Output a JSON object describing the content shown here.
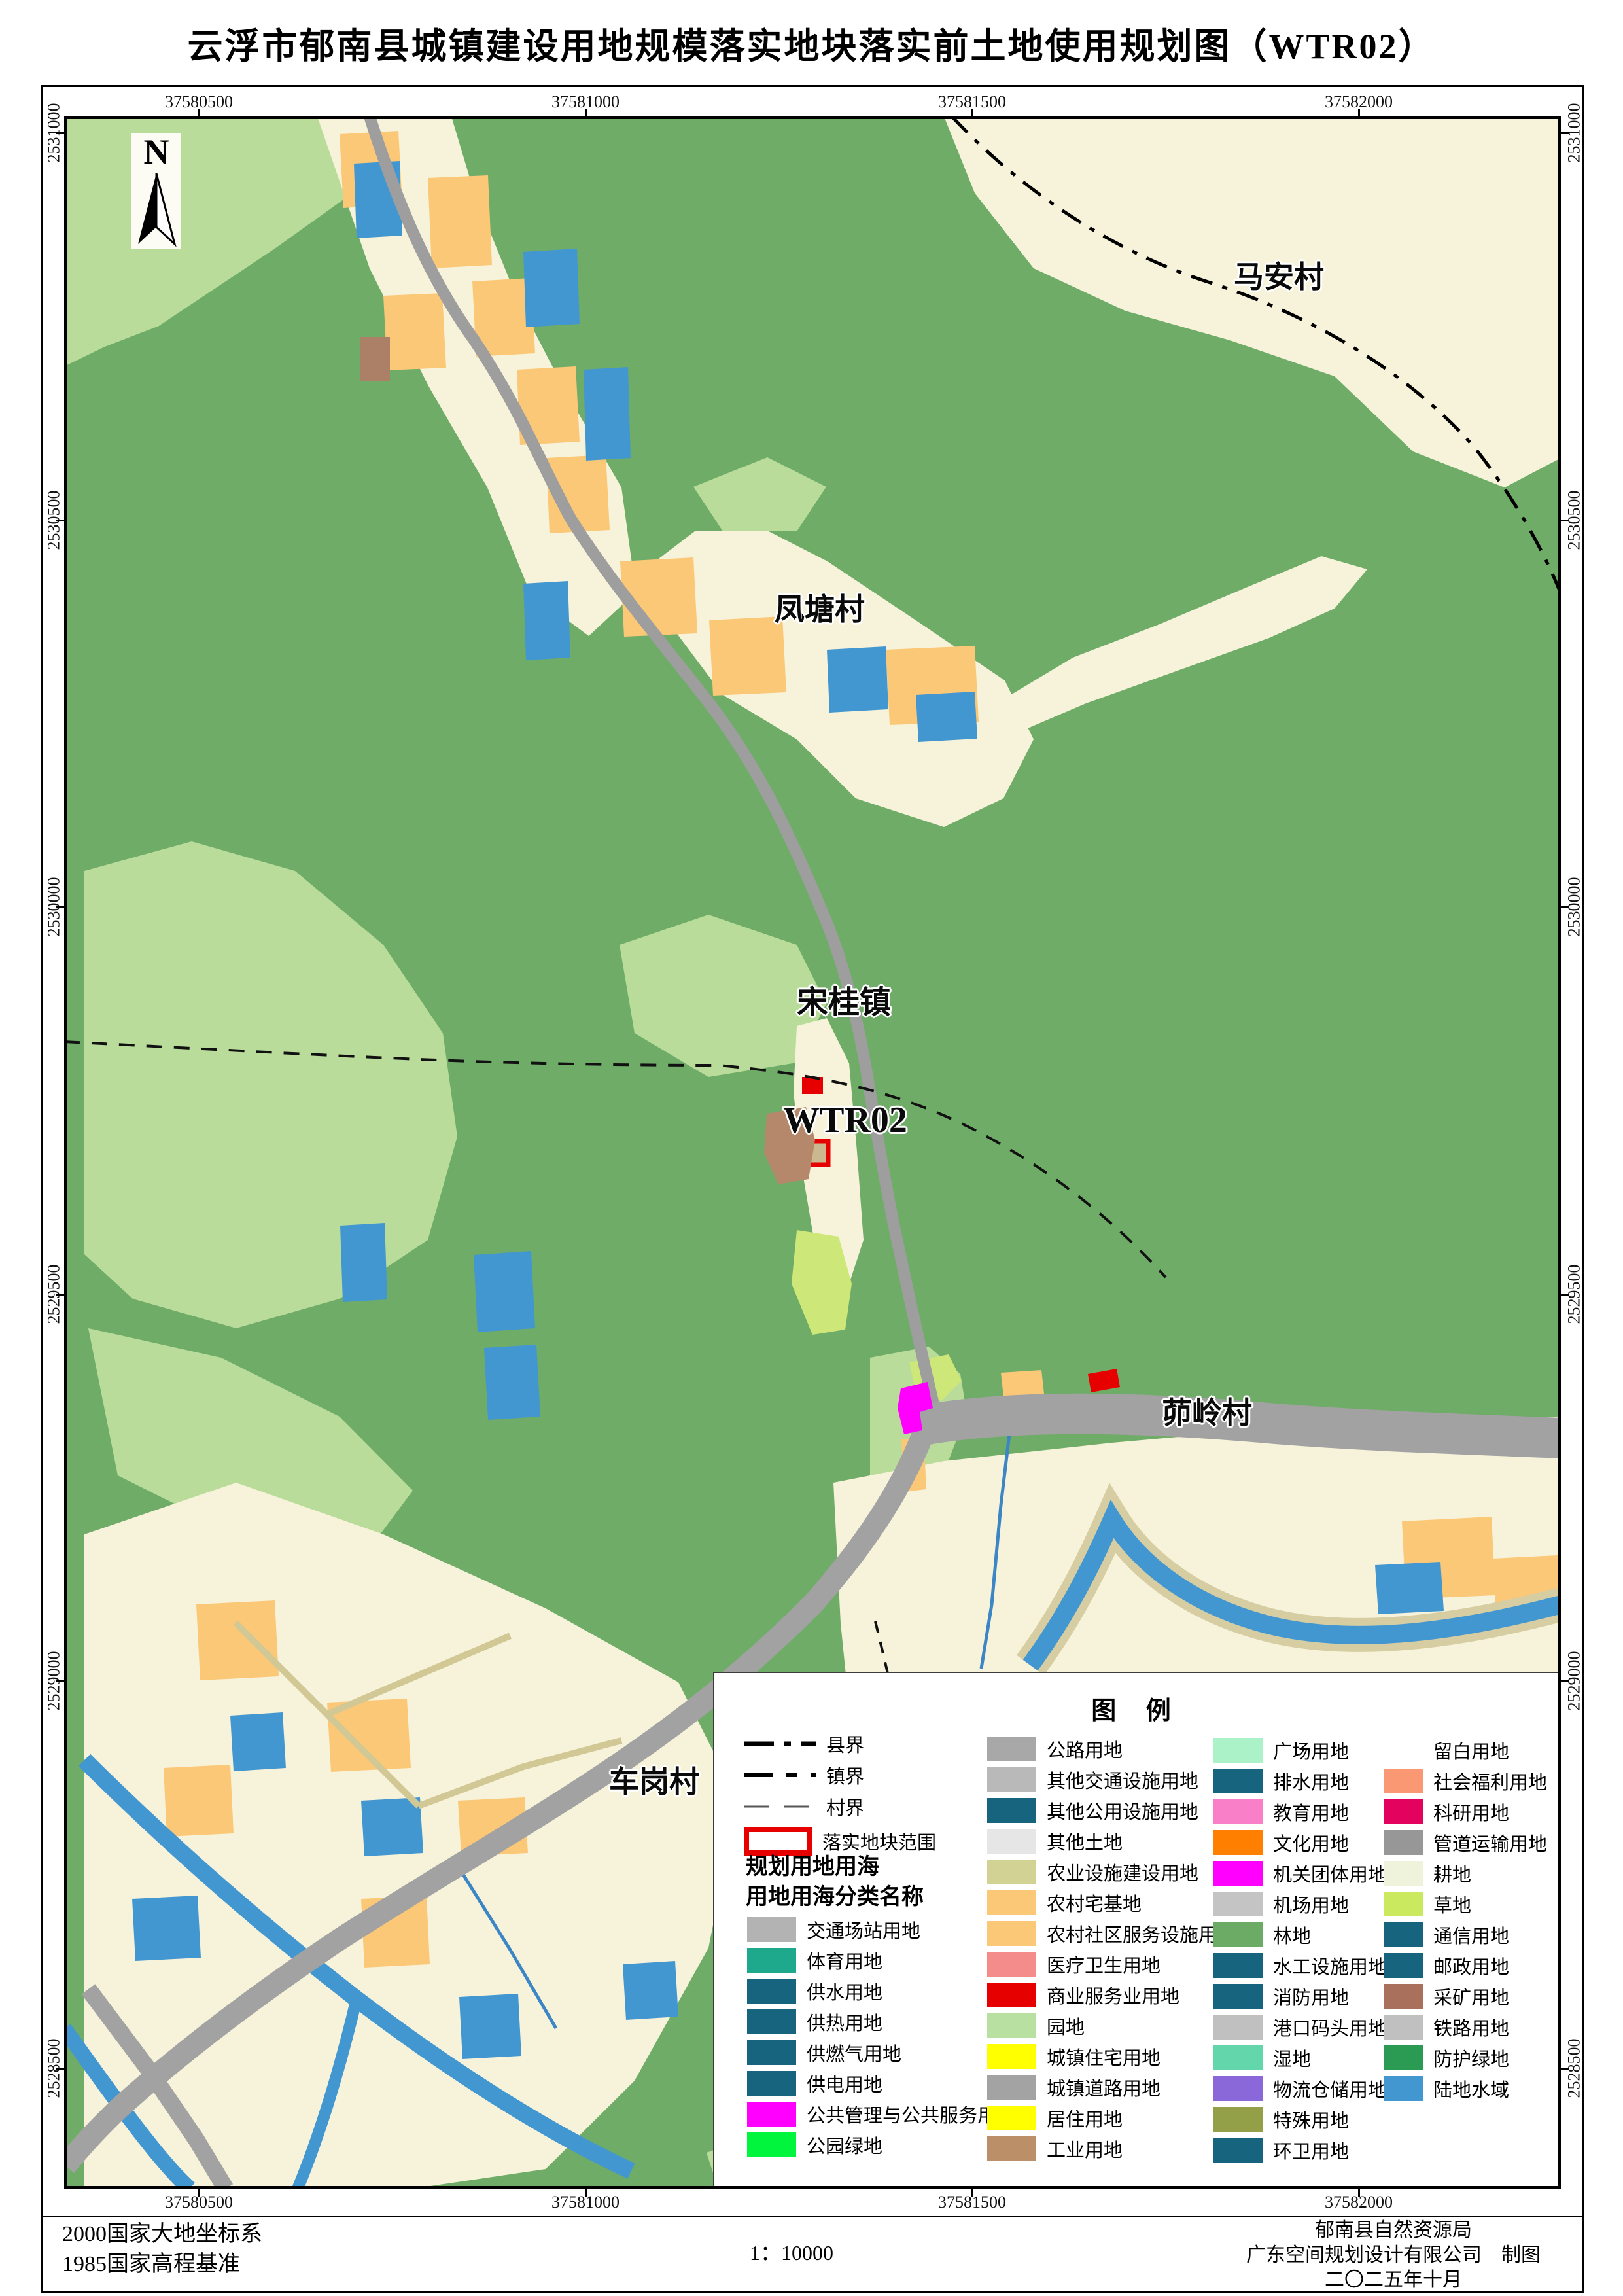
{
  "title": "云浮市郁南县城镇建设用地规模落实地块落实前土地使用规划图（WTR02）",
  "compass": {
    "label": "N"
  },
  "map": {
    "labels": {
      "maan": "马安村",
      "fengtang": "凤塘村",
      "songgui": "宋桂镇",
      "wtr02": "WTR02",
      "maoling": "茆岭村",
      "chegang": "车岗村"
    },
    "x_axis": [
      "37580500",
      "37581000",
      "37581500",
      "37582000"
    ],
    "y_axis": [
      "2531000",
      "2530500",
      "2530000",
      "2529500",
      "2529000",
      "2528500"
    ]
  },
  "legend": {
    "title": "图 例",
    "boundaries": [
      {
        "label": "县界",
        "style": "county"
      },
      {
        "label": "镇界",
        "style": "town"
      },
      {
        "label": "村界",
        "style": "village"
      }
    ],
    "plot_boundary": {
      "label": "落实地块范围",
      "color": "#e60000"
    },
    "headers": [
      "规划用地用海",
      "用地用海分类名称"
    ],
    "col1": [
      {
        "label": "交通场站用地",
        "color": "#b3b3b3"
      },
      {
        "label": "体育用地",
        "color": "#1fa98c"
      },
      {
        "label": "供水用地",
        "color": "#17647e"
      },
      {
        "label": "供热用地",
        "color": "#17647e"
      },
      {
        "label": "供燃气用地",
        "color": "#17647e"
      },
      {
        "label": "供电用地",
        "color": "#17647e"
      },
      {
        "label": "公共管理与公共服务用地",
        "color": "#ff00ff"
      },
      {
        "label": "公园绿地",
        "color": "#00f53c"
      }
    ],
    "col2": [
      {
        "label": "公路用地",
        "color": "#a8a8a8"
      },
      {
        "label": "其他交通设施用地",
        "color": "#b9b9b9"
      },
      {
        "label": "其他公用设施用地",
        "color": "#17647e"
      },
      {
        "label": "其他土地",
        "color": "#e6e6e6"
      },
      {
        "label": "农业设施建设用地",
        "color": "#d3d295"
      },
      {
        "label": "农村宅基地",
        "color": "#fbc878"
      },
      {
        "label": "农村社区服务设施用地",
        "color": "#fbc878"
      },
      {
        "label": "医疗卫生用地",
        "color": "#f58c8c"
      },
      {
        "label": "商业服务业用地",
        "color": "#e60000"
      },
      {
        "label": "园地",
        "color": "#b7e0a1"
      },
      {
        "label": "城镇住宅用地",
        "color": "#ffff00"
      },
      {
        "label": "城镇道路用地",
        "color": "#a3a3a3"
      },
      {
        "label": "居住用地",
        "color": "#ffff00"
      },
      {
        "label": "工业用地",
        "color": "#bb9069"
      }
    ],
    "col3": [
      {
        "label": "广场用地",
        "color": "#abf2c9"
      },
      {
        "label": "排水用地",
        "color": "#17647e"
      },
      {
        "label": "教育用地",
        "color": "#f97fc8"
      },
      {
        "label": "文化用地",
        "color": "#ff8000"
      },
      {
        "label": "机关团体用地",
        "color": "#ff00ff"
      },
      {
        "label": "机场用地",
        "color": "#c4c4c4"
      },
      {
        "label": "林地",
        "color": "#6cab66"
      },
      {
        "label": "水工设施用地",
        "color": "#17647e"
      },
      {
        "label": "消防用地",
        "color": "#17647e"
      },
      {
        "label": "港口码头用地",
        "color": "#c0c0c0"
      },
      {
        "label": "湿地",
        "color": "#63d6ac"
      },
      {
        "label": "物流仓储用地",
        "color": "#8b68d9"
      },
      {
        "label": "特殊用地",
        "color": "#93a048"
      },
      {
        "label": "环卫用地",
        "color": "#17647e"
      }
    ],
    "col4": [
      {
        "label": "留白用地",
        "color": "#ffffff"
      },
      {
        "label": "社会福利用地",
        "color": "#fa9873"
      },
      {
        "label": "科研用地",
        "color": "#e3035f"
      },
      {
        "label": "管道运输用地",
        "color": "#979797"
      },
      {
        "label": "耕地",
        "color": "#eff3dc"
      },
      {
        "label": "草地",
        "color": "#cbe95f"
      },
      {
        "label": "通信用地",
        "color": "#17647e"
      },
      {
        "label": "邮政用地",
        "color": "#17647e"
      },
      {
        "label": "采矿用地",
        "color": "#a9705c"
      },
      {
        "label": "铁路用地",
        "color": "#c0c0c0"
      },
      {
        "label": "防护绿地",
        "color": "#2b9a52"
      },
      {
        "label": "陆地水域",
        "color": "#4397d1"
      }
    ]
  },
  "footer": {
    "datum_line1": "2000国家大地坐标系",
    "datum_line2": "1985国家高程基准",
    "scale": "1：10000",
    "credit_line1": "郁南县自然资源局",
    "credit_line2": "广东空间规划设计有限公司　制图",
    "credit_line3": "二〇二五年十月"
  }
}
